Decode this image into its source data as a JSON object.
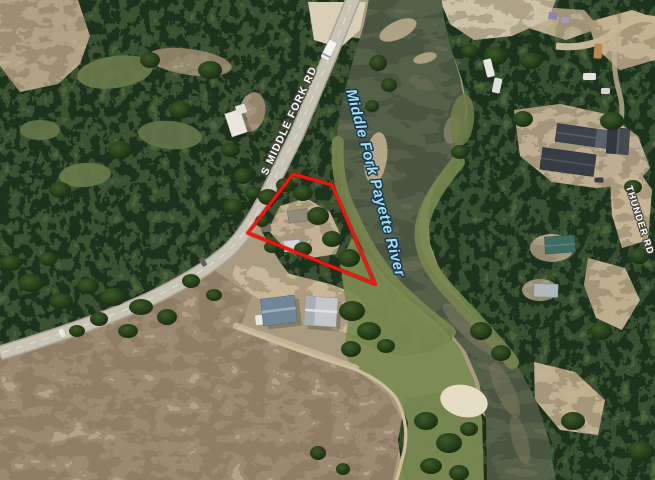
{
  "map": {
    "kind": "satellite-parcel-map",
    "labels": {
      "main_road": {
        "text": "S MIDDLE FORK RD",
        "color": "#ffffff",
        "halo": "#46463d"
      },
      "river": {
        "text": "Middle Fork Payette River",
        "color": "#a8dcee",
        "halo": "#163750"
      },
      "side_road": {
        "text": "THUNDER RD",
        "color": "#ffffff",
        "halo": "#46463d"
      }
    },
    "parcel": {
      "points": "293,174 332,185 375,284 248,233",
      "stroke_color": "#f2150e",
      "stroke_width": "3"
    }
  }
}
